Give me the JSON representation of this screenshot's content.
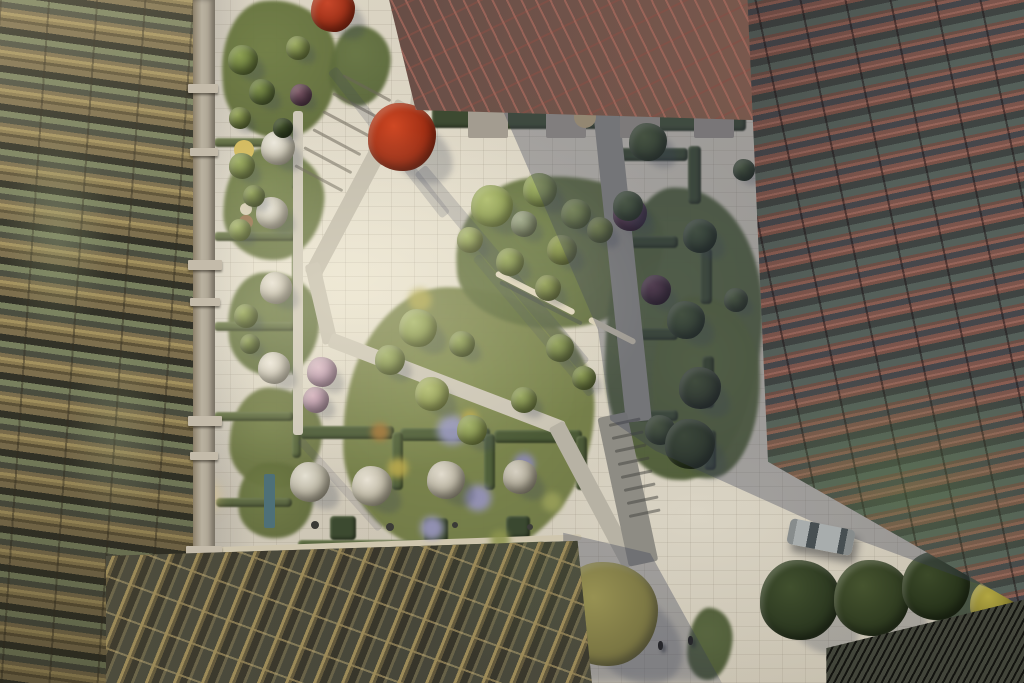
{
  "meta": {
    "description": "Aerial rendering of a landscaped residential courtyard between a bronze-lattice apartment building (left), a terracotta-lattice building (right), a red glass entrance canopy (top) and a golden glazed atrium roof (bottom)."
  },
  "scene": {
    "palette": {
      "paving": "#d8d1c0",
      "gold-base": "#7d6f4e",
      "gold-beam": "#a4925f",
      "gold-dark": "#5e5338",
      "concrete-light": "#c4bbaa",
      "red-base": "#7c554c",
      "red-beam": "#96655a",
      "glass-dark": "#3f4442",
      "canopy-red": "#6b5048",
      "canopy-gold": "#9c8a58",
      "canopy-glass": "#3f3c30",
      "shadow-col": "rgba(56,62,84,0.34)"
    },
    "beds": [
      [
        222,
        0,
        116,
        138,
        -4,
        "#6f7d44"
      ],
      [
        330,
        26,
        60,
        80,
        8,
        "#667542"
      ],
      [
        224,
        148,
        100,
        112,
        4,
        "#75834b"
      ],
      [
        228,
        272,
        92,
        104,
        -4,
        "#707e48"
      ],
      [
        230,
        388,
        92,
        100,
        3,
        "#76814a"
      ],
      [
        238,
        462,
        76,
        76,
        -5,
        "#6e7a44"
      ],
      [
        344,
        288,
        250,
        268,
        2,
        "#7e894d"
      ],
      [
        456,
        176,
        208,
        152,
        -3,
        "#6c7b45"
      ],
      [
        606,
        188,
        156,
        292,
        2,
        "#5a6a40"
      ],
      [
        652,
        296,
        108,
        182,
        -2,
        "#60703f"
      ],
      [
        688,
        608,
        44,
        72,
        6,
        "#55633c"
      ],
      [
        936,
        556,
        88,
        124,
        -4,
        "#49573a"
      ]
    ],
    "hedges": [
      [
        432,
        98,
        56,
        30,
        0,
        "#3d4a31"
      ],
      [
        500,
        95,
        62,
        34,
        0,
        "#425034"
      ],
      [
        574,
        97,
        54,
        32,
        0,
        "#3f4c32"
      ],
      [
        642,
        99,
        58,
        32,
        0,
        "#445236"
      ],
      [
        712,
        101,
        34,
        30,
        0,
        "#3c4830"
      ],
      [
        616,
        148,
        72,
        13,
        0,
        "#3c4a30"
      ],
      [
        688,
        146,
        13,
        58,
        0,
        "#3e4c31"
      ],
      [
        612,
        236,
        66,
        12,
        0,
        "#3b4930"
      ],
      [
        700,
        248,
        12,
        56,
        0,
        "#404e33"
      ],
      [
        616,
        328,
        62,
        12,
        0,
        "#3d4b31"
      ],
      [
        702,
        356,
        12,
        52,
        0,
        "#394629"
      ],
      [
        620,
        410,
        58,
        11,
        0,
        "#3f4d32"
      ],
      [
        704,
        430,
        12,
        40,
        0,
        "#3b4830"
      ],
      [
        300,
        426,
        94,
        13,
        0,
        "#4d5c38"
      ],
      [
        400,
        428,
        90,
        13,
        0,
        "#51603a"
      ],
      [
        494,
        430,
        88,
        13,
        0,
        "#4b5a36"
      ],
      [
        392,
        432,
        11,
        58,
        0,
        "#55643c"
      ],
      [
        484,
        434,
        11,
        56,
        0,
        "#50603a"
      ],
      [
        576,
        436,
        11,
        54,
        0,
        "#4c5a38"
      ],
      [
        298,
        540,
        246,
        11,
        0,
        "#57663e"
      ],
      [
        330,
        516,
        26,
        24,
        0,
        "#3c4a30"
      ],
      [
        424,
        518,
        24,
        24,
        0,
        "#404e32"
      ],
      [
        506,
        516,
        24,
        22,
        0,
        "#3a4830"
      ],
      [
        292,
        118,
        9,
        72,
        0,
        "#5c6a40"
      ],
      [
        292,
        206,
        9,
        80,
        0,
        "#5a683e"
      ],
      [
        292,
        298,
        9,
        78,
        0,
        "#586640"
      ],
      [
        292,
        388,
        9,
        70,
        0,
        "#5c6a40"
      ],
      [
        214,
        138,
        80,
        9,
        0,
        "#68744a"
      ],
      [
        214,
        232,
        82,
        9,
        0,
        "#667248"
      ],
      [
        214,
        322,
        82,
        9,
        0,
        "#687448"
      ],
      [
        214,
        412,
        80,
        9,
        0,
        "#647046"
      ],
      [
        216,
        498,
        76,
        9,
        0,
        "#5e6a44"
      ]
    ],
    "bars": [
      [
        430,
        2,
        100,
        20,
        96,
        "#c6c0b0",
        "path-segment"
      ],
      [
        404,
        94,
        196,
        17,
        118,
        "#c3bdad",
        "path-steps"
      ],
      [
        312,
        256,
        82,
        15,
        77,
        "#c6c0b0",
        "path-segment"
      ],
      [
        330,
        332,
        250,
        15,
        21,
        "#cbc5b5",
        "path-segment"
      ],
      [
        556,
        416,
        160,
        17,
        62,
        "#b7b2a4",
        "path-segment"
      ],
      [
        606,
        96,
        314,
        26,
        84,
        "#94928a",
        "path-segment"
      ],
      [
        612,
        400,
        152,
        30,
        78,
        "#8e8c84",
        "path-stairs"
      ],
      [
        298,
        106,
        324,
        10,
        90,
        "#cfc9b9",
        "path-walk"
      ],
      [
        420,
        84,
        334,
        9,
        1,
        "#a7a094",
        "terrace-walk"
      ],
      [
        104,
        551,
        478,
        6,
        -2,
        "#cfc6ae",
        "canopy-edge-beam"
      ],
      [
        343,
        74,
        54,
        3,
        28,
        "rgba(108,102,90,0.55)",
        "step-line"
      ],
      [
        333,
        92,
        54,
        3,
        28,
        "rgba(108,102,90,0.55)",
        "step-line"
      ],
      [
        323,
        110,
        54,
        3,
        28,
        "rgba(108,102,90,0.55)",
        "step-line"
      ],
      [
        313,
        128,
        54,
        3,
        28,
        "rgba(108,102,90,0.55)",
        "step-line"
      ],
      [
        304,
        146,
        54,
        3,
        28,
        "rgba(108,102,90,0.55)",
        "step-line"
      ],
      [
        295,
        164,
        54,
        3,
        28,
        "rgba(108,102,90,0.55)",
        "step-line"
      ],
      [
        609,
        424,
        32,
        3,
        -12,
        "rgba(66,66,62,0.5)",
        "step-line"
      ],
      [
        612,
        437,
        32,
        3,
        -12,
        "rgba(66,66,62,0.5)",
        "step-line"
      ],
      [
        615,
        450,
        32,
        3,
        -12,
        "rgba(66,66,62,0.5)",
        "step-line"
      ],
      [
        618,
        463,
        32,
        3,
        -12,
        "rgba(66,66,62,0.5)",
        "step-line"
      ],
      [
        621,
        476,
        32,
        3,
        -12,
        "rgba(66,66,62,0.5)",
        "step-line"
      ],
      [
        624,
        489,
        32,
        3,
        -12,
        "rgba(66,66,62,0.5)",
        "step-line"
      ],
      [
        627,
        502,
        32,
        3,
        -12,
        "rgba(66,66,62,0.5)",
        "step-line"
      ],
      [
        629,
        515,
        32,
        3,
        -12,
        "rgba(66,66,62,0.5)",
        "step-line"
      ],
      [
        420,
        162,
        255,
        15,
        50,
        "rgba(64,70,92,0.22)",
        "cast-shadow"
      ],
      [
        332,
        64,
        185,
        11,
        52,
        "rgba(64,70,92,0.2)",
        "cast-shadow"
      ],
      [
        476,
        252,
        180,
        9,
        50,
        "rgba(64,70,92,0.17)",
        "cast-shadow"
      ],
      [
        300,
        436,
        120,
        8,
        48,
        "rgba(64,70,92,0.15)",
        "cast-shadow"
      ],
      [
        500,
        280,
        92,
        4,
        27,
        "rgba(60,64,80,0.35)",
        "cast-shadow"
      ],
      [
        496,
        270,
        88,
        6,
        27,
        "#ded5bc",
        "bench"
      ],
      [
        589,
        316,
        52,
        6,
        27,
        "#d8cfb6",
        "bench"
      ]
    ],
    "rects": [
      [
        94,
        426,
        16,
        132,
        0,
        "#b2aa9a",
        "concrete-column"
      ],
      [
        264,
        474,
        11,
        54,
        0,
        "#4e7078",
        "entrance-door"
      ],
      [
        468,
        100,
        40,
        38,
        0,
        "#a39c90",
        "terrace-pad"
      ],
      [
        546,
        100,
        40,
        38,
        0,
        "#a7a094",
        "terrace-pad"
      ],
      [
        620,
        102,
        40,
        36,
        0,
        "#a19a8e",
        "terrace-pad"
      ],
      [
        694,
        102,
        40,
        36,
        0,
        "#9b948a",
        "terrace-pad"
      ]
    ],
    "discs": [
      [
        244,
        150,
        10,
        "#d4bc62",
        0,
        "umbrella-table"
      ],
      [
        246,
        222,
        7,
        "#9a7856",
        0,
        "table"
      ],
      [
        246,
        209,
        6,
        "#d6cdb4",
        0,
        "table"
      ],
      [
        585,
        117,
        11,
        "#c2ad82",
        0,
        "round-rug"
      ],
      [
        661,
        109,
        8,
        "#56504a",
        0,
        "round-rug"
      ],
      [
        204,
        496,
        7,
        "#f4da92",
        2,
        "pendant-lamp"
      ],
      [
        452,
        430,
        18,
        "#9b9ac8",
        1,
        "flower-patch"
      ],
      [
        478,
        498,
        16,
        "#9894c4",
        1,
        "flower-patch"
      ],
      [
        432,
        528,
        14,
        "#a09cc8",
        1,
        "flower-patch"
      ],
      [
        524,
        464,
        13,
        "#8e8abc",
        1,
        "flower-patch"
      ],
      [
        398,
        468,
        12,
        "#c0ae4e",
        1,
        "flower-patch"
      ],
      [
        470,
        418,
        10,
        "#b8a84a",
        1,
        "flower-patch"
      ],
      [
        380,
        432,
        11,
        "#a87838",
        1,
        "flower-patch"
      ],
      [
        552,
        502,
        12,
        "#9aa05a",
        1,
        "flower-patch"
      ],
      [
        420,
        300,
        14,
        "#b0a850",
        1,
        "flower-patch"
      ],
      [
        500,
        540,
        12,
        "#8e964e",
        1,
        "flower-patch"
      ],
      [
        562,
        99,
        4,
        "#3c3c38",
        0,
        "grill"
      ],
      [
        678,
        94,
        4,
        "#403e3a",
        0,
        "grill"
      ],
      [
        315,
        525,
        4,
        "#3a3a36",
        0,
        "grill"
      ],
      [
        390,
        527,
        4,
        "#3c3c38",
        0,
        "grill"
      ],
      [
        455,
        525,
        3,
        "#3a3a36",
        0,
        "grill"
      ],
      [
        530,
        527,
        3,
        "#3c3c38",
        0,
        "grill"
      ],
      [
        507,
        33,
        4,
        "#3a3a38",
        0,
        "bicycle"
      ],
      [
        512,
        37,
        3,
        "#444440",
        0,
        "bicycle"
      ]
    ],
    "trees": [
      [
        333,
        10,
        22,
        "#c8472a",
        "#8c2812"
      ],
      [
        402,
        137,
        34,
        "#cf4824",
        "#8e250e"
      ],
      [
        278,
        148,
        17,
        "#ece8dc",
        "#b6b09c"
      ],
      [
        272,
        213,
        16,
        "#eae6da",
        "#b4ae9a"
      ],
      [
        276,
        288,
        16,
        "#e8e2d6",
        "#b0aa96"
      ],
      [
        274,
        368,
        16,
        "#ece6da",
        "#b6b09e"
      ],
      [
        322,
        372,
        15,
        "#d9bac6",
        "#a5839a"
      ],
      [
        316,
        400,
        13,
        "#d2aebc",
        "#9c7e92"
      ],
      [
        310,
        482,
        20,
        "#e4e0d2",
        "#a6a08c"
      ],
      [
        372,
        486,
        20,
        "#e8e2d4",
        "#aaa48e"
      ],
      [
        446,
        480,
        19,
        "#e2dcce",
        "#a29c88"
      ],
      [
        520,
        477,
        17,
        "#d6d0c2",
        "#9a9480"
      ],
      [
        243,
        60,
        15,
        "#8da052",
        "#5a6a34"
      ],
      [
        262,
        92,
        13,
        "#7e904a",
        "#4e5e30"
      ],
      [
        298,
        48,
        12,
        "#99a85e",
        "#68763c"
      ],
      [
        240,
        118,
        11,
        "#93a256",
        "#5e6c36"
      ],
      [
        301,
        95,
        11,
        "#7c5866",
        "#503646"
      ],
      [
        283,
        128,
        10,
        "#46562e",
        "#2a381c"
      ],
      [
        242,
        166,
        13,
        "#9aaa5e",
        "#6a783e"
      ],
      [
        254,
        196,
        11,
        "#8e9e54",
        "#5c6a36"
      ],
      [
        240,
        230,
        11,
        "#a2b266",
        "#70803e"
      ],
      [
        246,
        316,
        12,
        "#96a65a",
        "#647238"
      ],
      [
        250,
        344,
        10,
        "#8a9a50",
        "#586634"
      ],
      [
        492,
        206,
        21,
        "#adbc6c",
        "#7c8c44"
      ],
      [
        540,
        190,
        17,
        "#9fb062",
        "#6e7e40"
      ],
      [
        576,
        214,
        15,
        "#95a65c",
        "#647438"
      ],
      [
        524,
        224,
        13,
        "#9ca687",
        "#6c7656"
      ],
      [
        562,
        250,
        15,
        "#92a052",
        "#626e34"
      ],
      [
        600,
        230,
        13,
        "#8a984e",
        "#5a6832"
      ],
      [
        630,
        214,
        17,
        "#6c4657",
        "#422639"
      ],
      [
        656,
        290,
        15,
        "#5e3e4e",
        "#38212e"
      ],
      [
        470,
        240,
        13,
        "#a4b468",
        "#747f42"
      ],
      [
        510,
        262,
        14,
        "#98a85c",
        "#66743a"
      ],
      [
        548,
        288,
        13,
        "#8e9c52",
        "#5e6a34"
      ],
      [
        648,
        142,
        19,
        "#4e5e38",
        "#2e3c22"
      ],
      [
        628,
        206,
        15,
        "#546440",
        "#344428"
      ],
      [
        700,
        236,
        17,
        "#48583a",
        "#283622"
      ],
      [
        686,
        320,
        19,
        "#4b5b37",
        "#2b3923"
      ],
      [
        700,
        388,
        21,
        "#465432",
        "#262f1e"
      ],
      [
        660,
        430,
        15,
        "#4f5d39",
        "#2f3d25"
      ],
      [
        736,
        300,
        12,
        "#52623c",
        "#323e26"
      ],
      [
        744,
        170,
        11,
        "#4a5a36",
        "#2a3820"
      ],
      [
        418,
        328,
        19,
        "#a6b66a",
        "#76843e"
      ],
      [
        390,
        360,
        15,
        "#9cac62",
        "#6c7a3a"
      ],
      [
        462,
        344,
        13,
        "#92a258",
        "#627036"
      ],
      [
        432,
        394,
        17,
        "#aeba6c",
        "#7e8a42"
      ],
      [
        472,
        430,
        15,
        "#9eae62",
        "#6e7c3a"
      ],
      [
        524,
        400,
        13,
        "#94a45a",
        "#647236"
      ],
      [
        560,
        348,
        14,
        "#8c9c54",
        "#5c6a36"
      ],
      [
        584,
        378,
        12,
        "#889850",
        "#586632"
      ],
      [
        606,
        614,
        52,
        "#c9bd52",
        "#958b36"
      ],
      [
        690,
        444,
        25,
        "#3e4c2c",
        "#24301a"
      ],
      [
        800,
        600,
        40,
        "#41502e",
        "#27331d"
      ],
      [
        872,
        598,
        38,
        "#46542f",
        "#2a361d"
      ],
      [
        936,
        586,
        34,
        "#3c4a29",
        "#222e17"
      ],
      [
        994,
        604,
        24,
        "#b2a642",
        "#7c742a"
      ]
    ],
    "balconies": [
      [
        188,
        84,
        30,
        9
      ],
      [
        190,
        148,
        28,
        8
      ],
      [
        188,
        260,
        34,
        10
      ],
      [
        190,
        298,
        30,
        8
      ],
      [
        188,
        416,
        34,
        10
      ],
      [
        190,
        452,
        28,
        8
      ],
      [
        186,
        546,
        36,
        10
      ],
      [
        190,
        592,
        30,
        8
      ]
    ],
    "people": [
      [
        658,
        641
      ],
      [
        688,
        636
      ]
    ],
    "car": {
      "x": 788,
      "y": 524,
      "w": 66,
      "h": 26,
      "ang": 11,
      "body": "#a8adad",
      "glass": "#474f52",
      "shade": "#878c8c"
    }
  }
}
